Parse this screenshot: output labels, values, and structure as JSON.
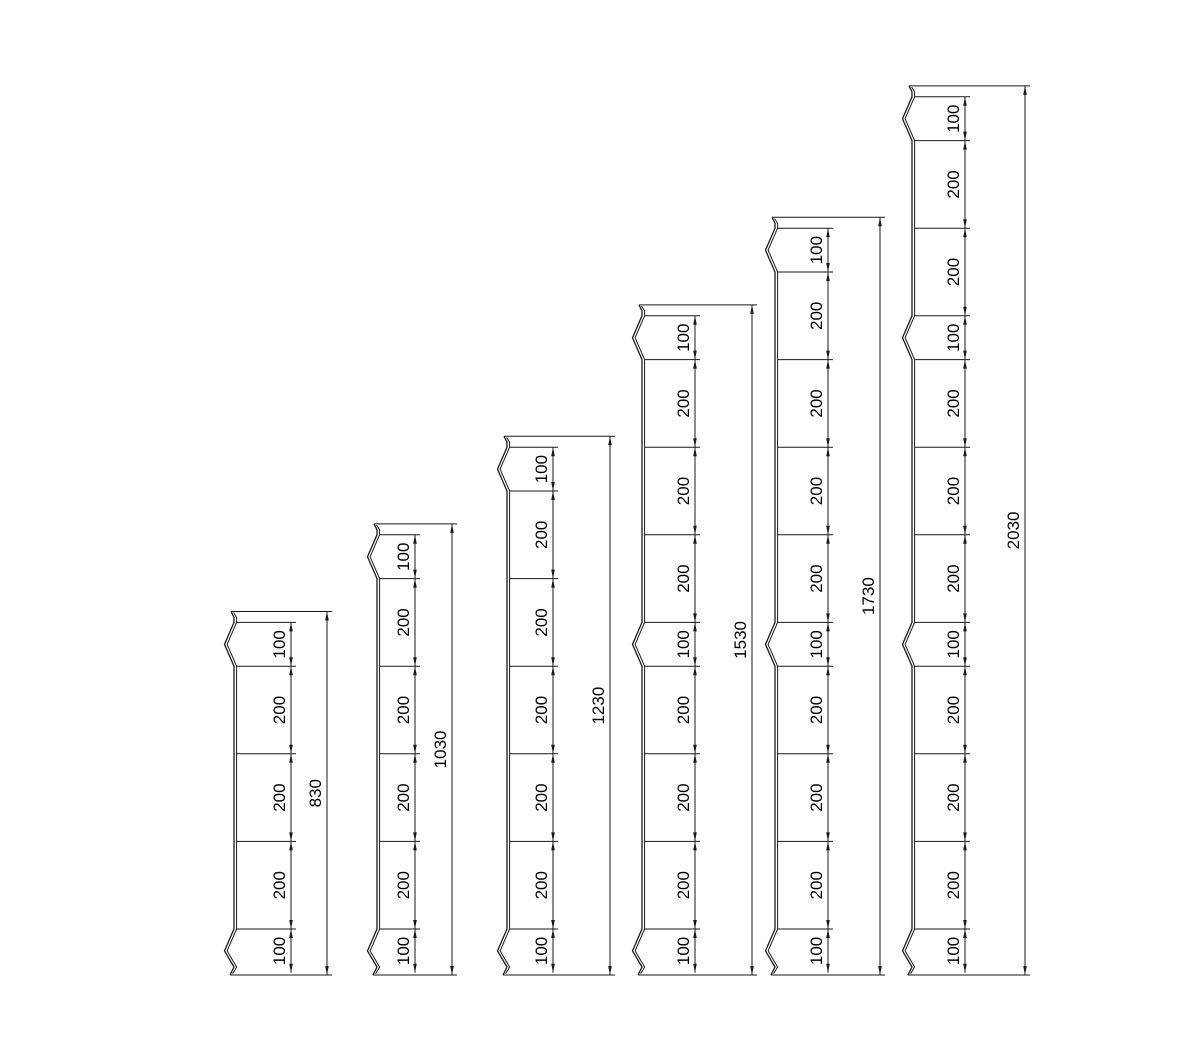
{
  "canvas": {
    "background": "#ffffff",
    "line_color": "#1a1a1a",
    "text_color": "#000000",
    "label_font_size": 17
  },
  "drawing": {
    "title": "palisade-post-height-variants",
    "profiles": [
      {
        "id": "post-830",
        "total_label": "830",
        "segments": [
          {
            "label": "100",
            "notch": true
          },
          {
            "label": "200",
            "notch": false
          },
          {
            "label": "200",
            "notch": false
          },
          {
            "label": "200",
            "notch": false
          },
          {
            "label": "100",
            "notch": true
          }
        ]
      },
      {
        "id": "post-1030",
        "total_label": "1030",
        "segments": [
          {
            "label": "100",
            "notch": true
          },
          {
            "label": "200",
            "notch": false
          },
          {
            "label": "200",
            "notch": false
          },
          {
            "label": "200",
            "notch": false
          },
          {
            "label": "200",
            "notch": false
          },
          {
            "label": "100",
            "notch": true
          }
        ]
      },
      {
        "id": "post-1230",
        "total_label": "1230",
        "segments": [
          {
            "label": "100",
            "notch": true
          },
          {
            "label": "200",
            "notch": false
          },
          {
            "label": "200",
            "notch": false
          },
          {
            "label": "200",
            "notch": false
          },
          {
            "label": "200",
            "notch": false
          },
          {
            "label": "200",
            "notch": false
          },
          {
            "label": "100",
            "notch": true
          }
        ]
      },
      {
        "id": "post-1530",
        "total_label": "1530",
        "segments": [
          {
            "label": "100",
            "notch": true
          },
          {
            "label": "200",
            "notch": false
          },
          {
            "label": "200",
            "notch": false
          },
          {
            "label": "200",
            "notch": false
          },
          {
            "label": "100",
            "notch": true
          },
          {
            "label": "200",
            "notch": false
          },
          {
            "label": "200",
            "notch": false
          },
          {
            "label": "200",
            "notch": false
          },
          {
            "label": "100",
            "notch": true
          }
        ]
      },
      {
        "id": "post-1730",
        "total_label": "1730",
        "segments": [
          {
            "label": "100",
            "notch": true
          },
          {
            "label": "200",
            "notch": false
          },
          {
            "label": "200",
            "notch": false
          },
          {
            "label": "200",
            "notch": false
          },
          {
            "label": "200",
            "notch": false
          },
          {
            "label": "100",
            "notch": true
          },
          {
            "label": "200",
            "notch": false
          },
          {
            "label": "200",
            "notch": false
          },
          {
            "label": "200",
            "notch": false
          },
          {
            "label": "100",
            "notch": true
          }
        ]
      },
      {
        "id": "post-2030",
        "total_label": "2030",
        "segments": [
          {
            "label": "100",
            "notch": true
          },
          {
            "label": "200",
            "notch": false
          },
          {
            "label": "200",
            "notch": false
          },
          {
            "label": "100",
            "notch": true
          },
          {
            "label": "200",
            "notch": false
          },
          {
            "label": "200",
            "notch": false
          },
          {
            "label": "200",
            "notch": false
          },
          {
            "label": "100",
            "notch": true
          },
          {
            "label": "200",
            "notch": false
          },
          {
            "label": "200",
            "notch": false
          },
          {
            "label": "200",
            "notch": false
          },
          {
            "label": "100",
            "notch": true
          }
        ]
      }
    ]
  }
}
